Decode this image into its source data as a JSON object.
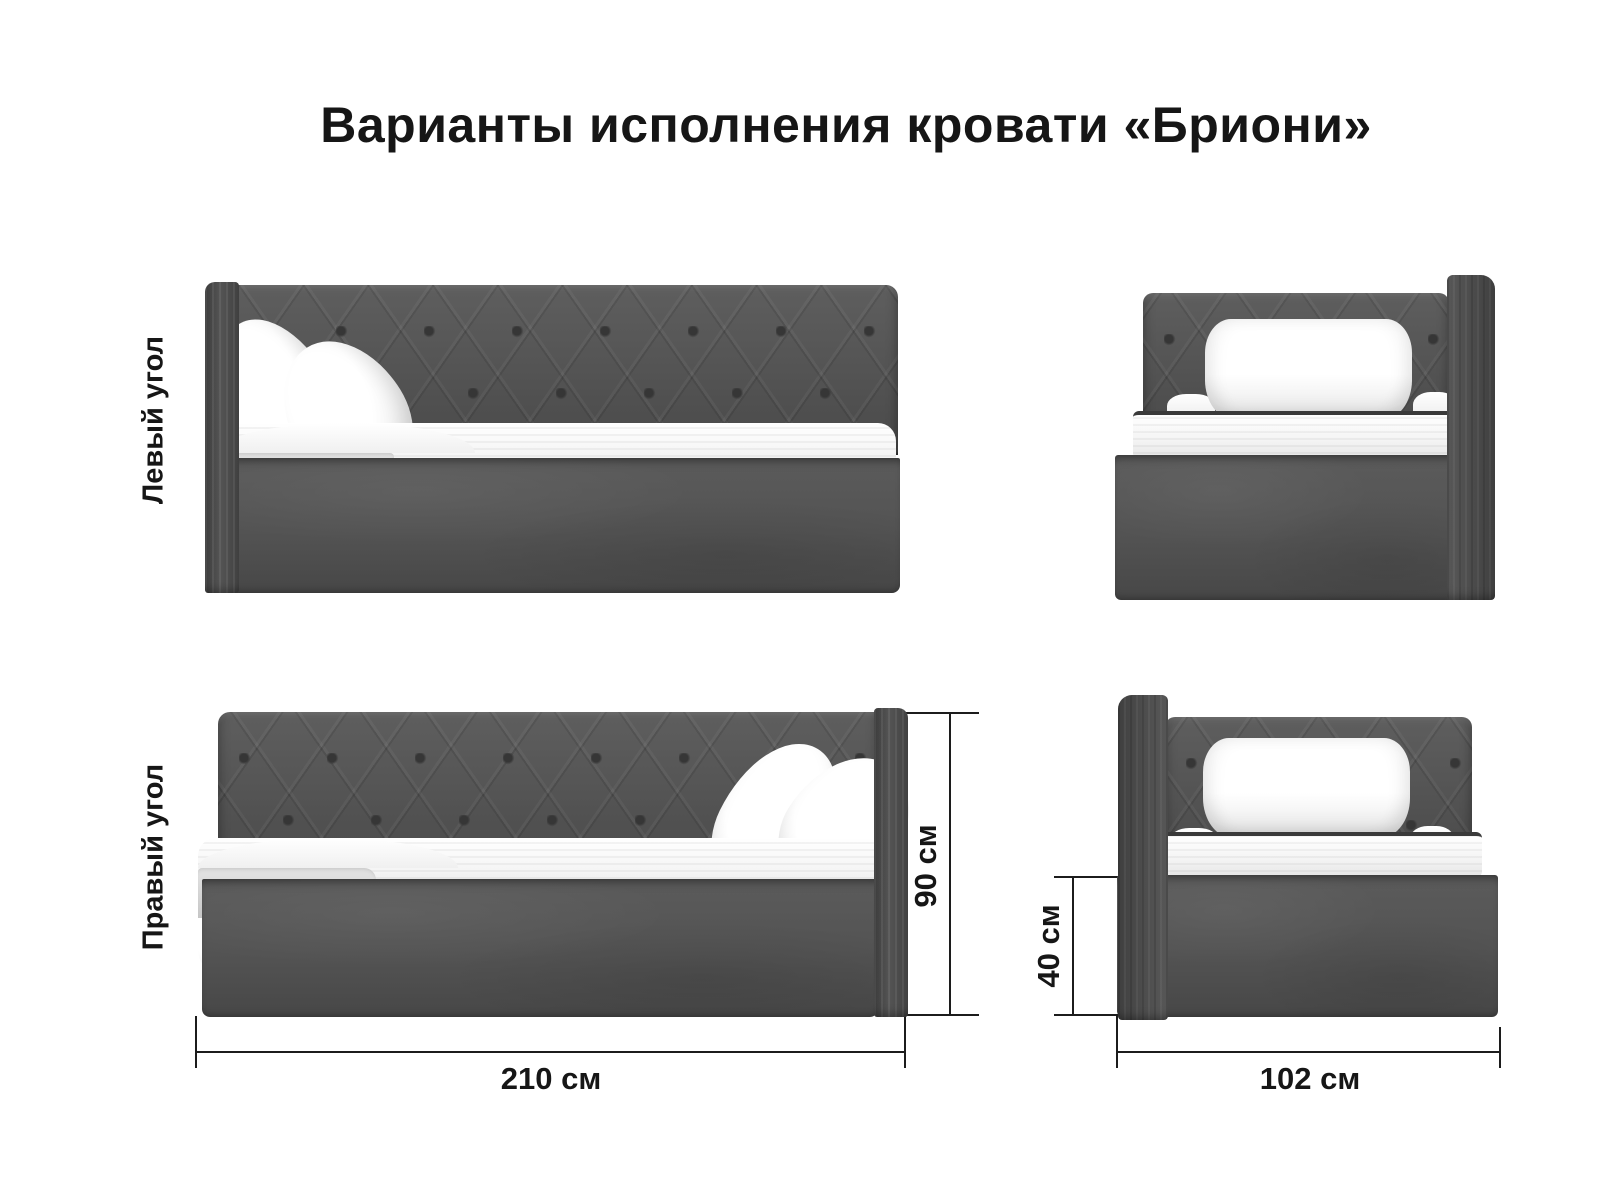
{
  "page": {
    "title": "Варианты исполнения кровати «Бриони»"
  },
  "variants": [
    {
      "id": "left-corner",
      "label": "Левый угол"
    },
    {
      "id": "right-corner",
      "label": "Правый угол"
    }
  ],
  "dimensions": {
    "height": "90 см",
    "length": "210 см",
    "base_height": "40 см",
    "width": "102 см"
  },
  "views": [
    {
      "name": "left-corner-side-view"
    },
    {
      "name": "left-corner-front-view"
    },
    {
      "name": "right-corner-side-view"
    },
    {
      "name": "right-corner-front-view"
    }
  ],
  "colors": {
    "bg": "#ffffff",
    "text": "#161616",
    "line": "#1c1c1c",
    "fabric": "#545454",
    "button": "#363636",
    "blanket": "#c7c7c7"
  }
}
